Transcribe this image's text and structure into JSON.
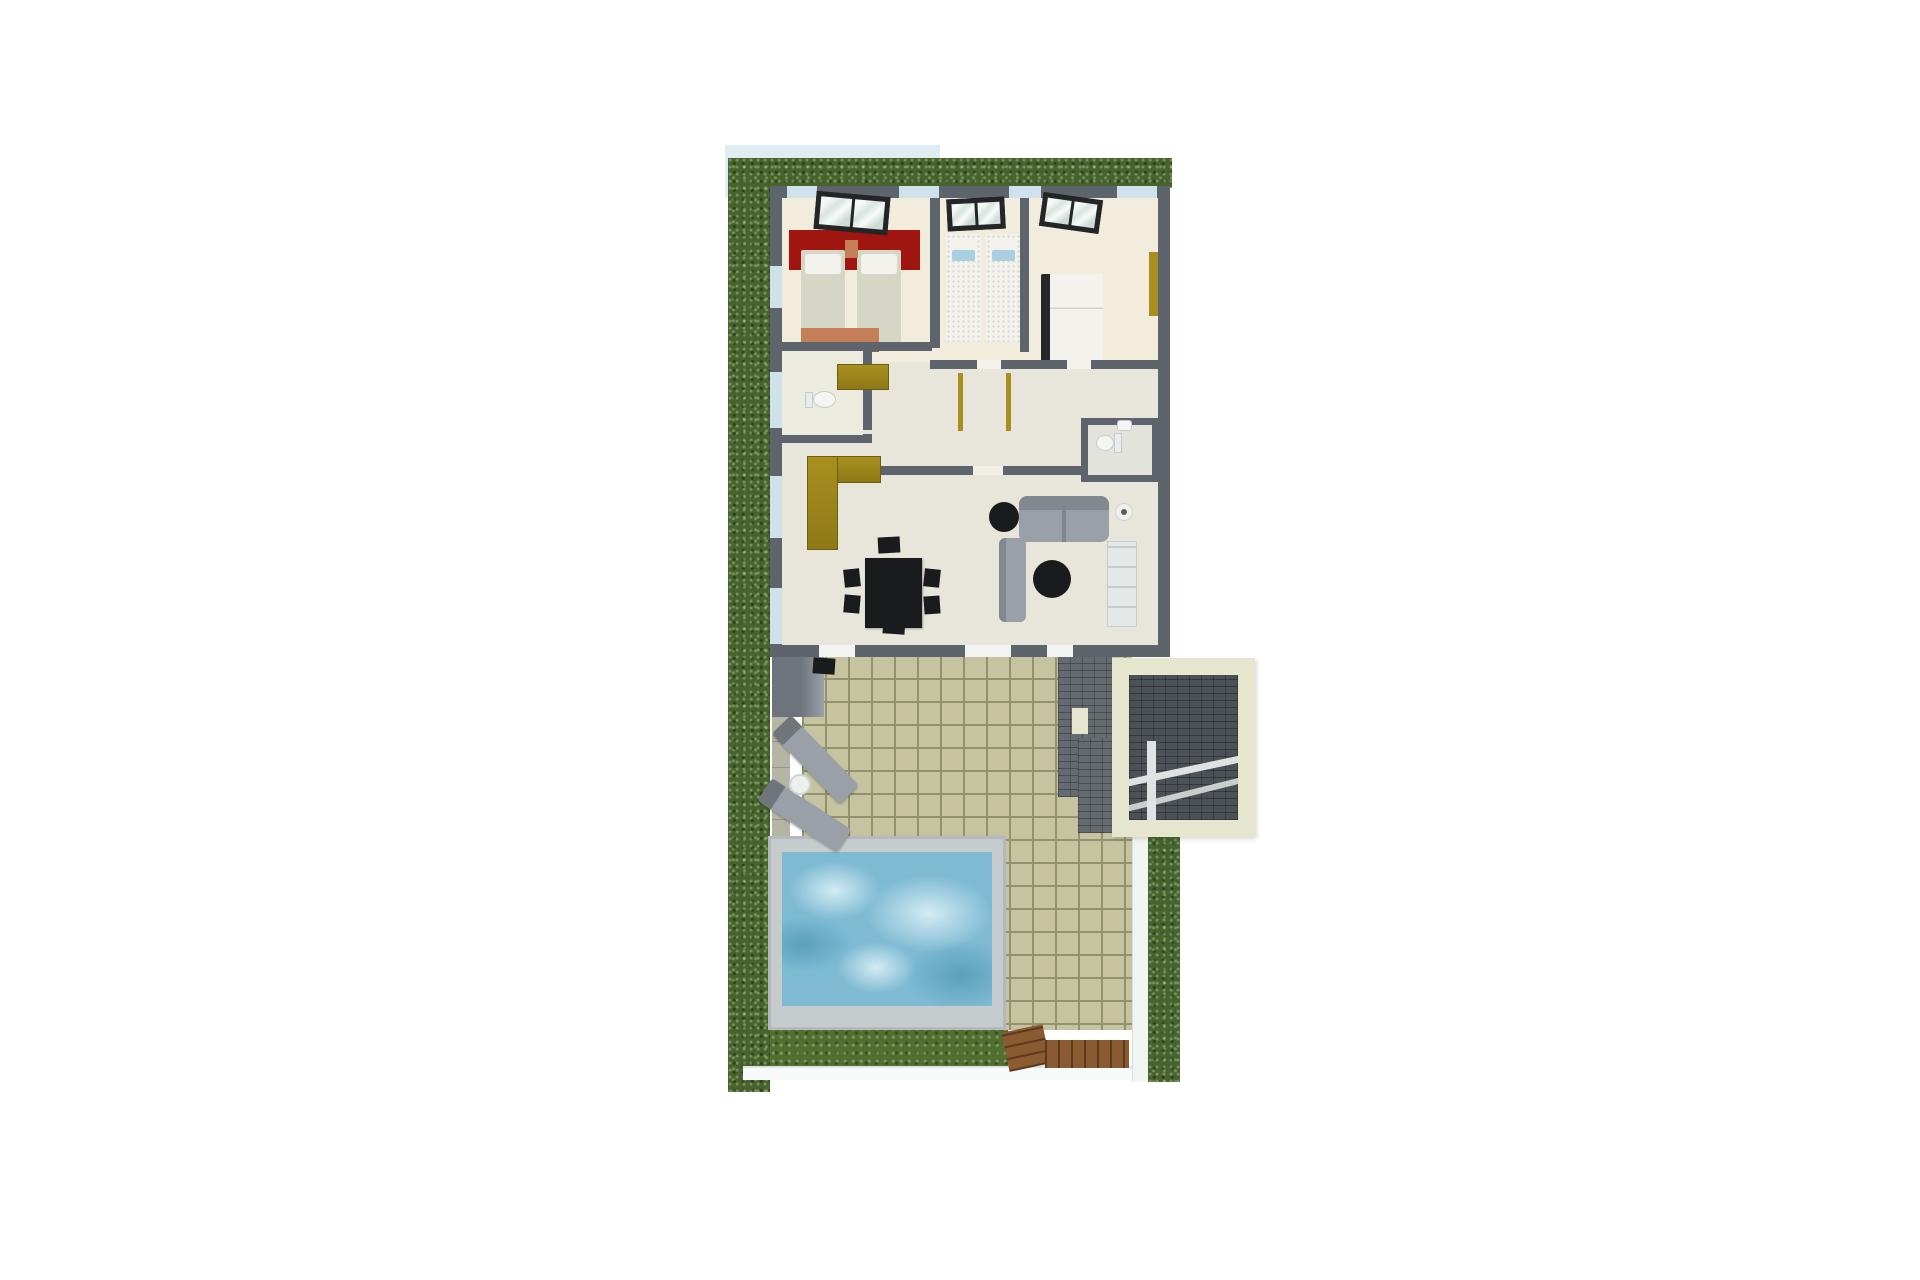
{
  "scene": {
    "kind": "3d-architectural-floor-plan-render",
    "view": "top-down"
  },
  "colors": {
    "page_bg": "#ffffff",
    "baseplate": "#dfedf3",
    "walkway": "#f7fafa",
    "hedge": "#47632c",
    "grass": "#516f2f",
    "paver": "#b5b5a5",
    "wall": "#5d646c",
    "floor_main": "#e8e6db",
    "floor_bedroom": "#f1ecdc",
    "floor_bath": "#e2e3da",
    "glass_blue": "#cfe2ec",
    "door_white": "#f2f4f4",
    "red_accent": "#a11510",
    "bed_blanket": "#d6d6c6",
    "bed_white": "#f3f2ed",
    "bed_pattern_dot": "#d9d9d0",
    "pillow_blue": "#a9cfe2",
    "orange": "#c47f59",
    "olive": "#8f7917",
    "olive_light": "#a8901f",
    "gold": "#a98d1e",
    "black": "#1a1b1d",
    "sofa": "#99a0a7",
    "sofa_dark": "#818890",
    "cabinet": "#e5e8e8",
    "tile": "#c6c4a0",
    "grout": "#92926f",
    "pool_deck": "#c6cbcd",
    "pool_water": "#7fbad3",
    "pool_swirl_light": "#d3ecf4",
    "pool_swirl_dark": "#5ba0bd",
    "stone": "#656b70",
    "beige_frame": "#e6e6cf",
    "wood": "#8a5a30",
    "wood_line": "#5c3a1e",
    "window_frame": "#232527",
    "angled_wall": "#6d747b",
    "wc_white": "#f4f6f6",
    "red": "#a11510"
  },
  "rooms": [
    {
      "name": "bedroom-1",
      "features": [
        "red-accent-wall",
        "single-bed",
        "single-bed",
        "nightstand",
        "dresser",
        "window"
      ]
    },
    {
      "name": "bedroom-2",
      "features": [
        "single-bed",
        "single-bed",
        "blue-cushions",
        "window"
      ]
    },
    {
      "name": "master-bedroom",
      "features": [
        "double-bed",
        "gold-wardrobe",
        "window"
      ]
    },
    {
      "name": "wc",
      "features": [
        "toilet"
      ]
    },
    {
      "name": "bathroom",
      "features": [
        "toilet",
        "sink"
      ]
    },
    {
      "name": "kitchen",
      "features": [
        "l-shaped-counter",
        "upper-counter"
      ]
    },
    {
      "name": "living-dining-room",
      "features": [
        "dining-table",
        "six-chairs",
        "sectional-sofa",
        "round-coffee-table",
        "round-coffee-table",
        "tv-cabinet",
        "floor-lamp"
      ]
    }
  ],
  "outdoor": [
    {
      "name": "perimeter-hedge"
    },
    {
      "name": "paver-path"
    },
    {
      "name": "tiled-terrace"
    },
    {
      "name": "sun-lounger",
      "count": 2
    },
    {
      "name": "round-side-table"
    },
    {
      "name": "swimming-pool"
    },
    {
      "name": "lawn-strip"
    },
    {
      "name": "stone-stair-structure",
      "features": [
        "beige-portal-frame",
        "ramp",
        "window-opening"
      ]
    },
    {
      "name": "wooden-entry-steps",
      "count": 2
    },
    {
      "name": "white-walkway"
    }
  ]
}
